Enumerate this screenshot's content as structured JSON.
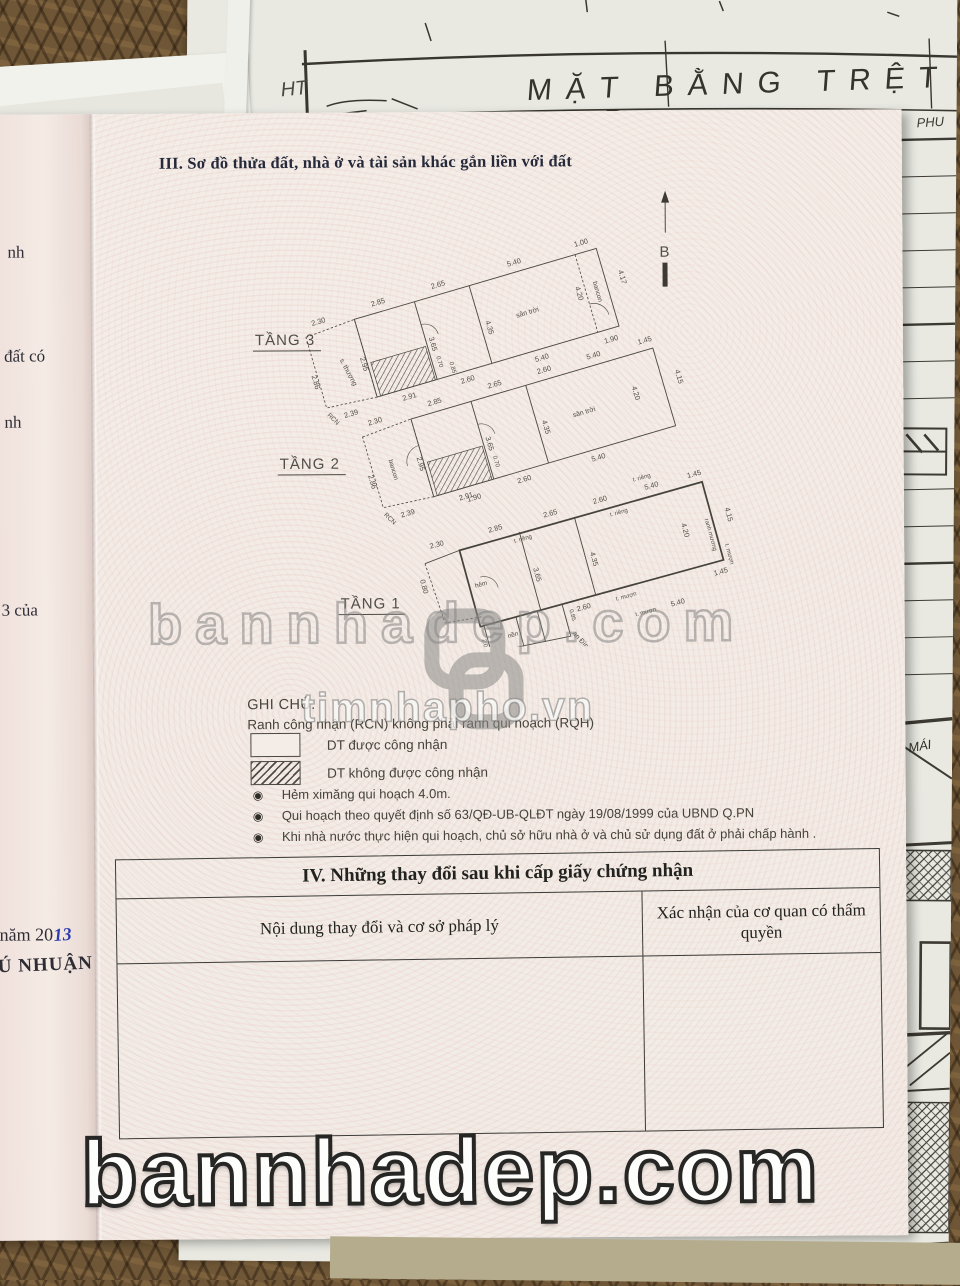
{
  "backdrop": {
    "blueprint_title": "MẶT BẰNG TRỆT",
    "blueprint_hand_note": "HT",
    "blueprint_corner_note": "PHU",
    "roof_label": "MÁI"
  },
  "certificate": {
    "section_iii_title": "III. Sơ đồ thửa đất, nhà ở và tài sản khác gắn liền với đất",
    "north_label": "B",
    "edge_fragments": [
      "nh",
      "đất có",
      "nh",
      "3 của"
    ],
    "edge_year_printed": "năm 20",
    "edge_year_handwritten": "13",
    "edge_district_fragment": "Ú NHUẬN"
  },
  "plans": {
    "t3": {
      "label": "TẦNG 3",
      "room_left": "s. thượng",
      "room_main": "sân trời",
      "balcony": "bancon",
      "boundary": "RCN",
      "d": [
        "2.30",
        "2.85",
        "2.65",
        "5.40",
        "1.00",
        "4.17",
        "4.20",
        "1.90",
        "2.95",
        "2.86",
        "3.65",
        "4.35",
        "0.70",
        "0.85",
        "2.39",
        "2.91",
        "2.60",
        "5.40"
      ]
    },
    "t2": {
      "label": "TẦNG 2",
      "room_main": "sân trời",
      "balcony": "bancon",
      "boundary": "RCN",
      "d": [
        "2.30",
        "2.85",
        "2.65",
        "2.60",
        "5.40",
        "1.45",
        "4.15",
        "4.20",
        "2.95",
        "2.86",
        "3.65",
        "4.35",
        "0.70",
        "1.90",
        "2.39",
        "2.91",
        "2.60",
        "5.40"
      ]
    },
    "t1": {
      "label": "TẦNG 1",
      "alley": "hẻm",
      "room": "nền",
      "street": "an Đình Ph",
      "walls": [
        "t. riêng",
        "t. riêng",
        "t. riêng",
        "t. mượn",
        "t. mượn",
        "t. mượn",
        "ranh mương"
      ],
      "d": [
        "0.80",
        "1.69",
        "2.30",
        "2.85",
        "2.65",
        "2.60",
        "5.40",
        "1.45",
        "4.15",
        "4.20",
        "1.45",
        "3.65",
        "4.35",
        "1.90",
        "2.60",
        "5.40",
        "2.05",
        "0.85"
      ]
    }
  },
  "legend": {
    "title": "GHI CHÚ:",
    "boundary_note": "Ranh công nhận (RCN) không phải ranh qui hoạch (RQH)",
    "recognized": "DT  được công nhận",
    "not_recognized": "DT không được công nhận",
    "notes": [
      "Hẻm ximăng qui hoạch 4.0m.",
      "Qui hoạch theo quyết định số 63/QĐ-UB-QLĐT ngày 19/08/1999 của UBND Q.PN",
      "Khi nhà nước thực hiện qui hoạch, chủ sở hữu nhà ở và chủ sử dụng đất ở phải chấp hành ."
    ]
  },
  "section_iv": {
    "title": "IV. Những thay đổi sau khi cấp giấy chứng nhận",
    "col_content": "Nội dung thay đổi và cơ sở pháp lý",
    "col_confirm": "Xác nhận của cơ quan có thẩm quyền"
  },
  "watermarks": {
    "center_text": "bannhadep.com",
    "site_text": "timnhapho.vn",
    "bottom_text": "bannhadep.com"
  },
  "icons": {
    "bullet": "◉"
  }
}
